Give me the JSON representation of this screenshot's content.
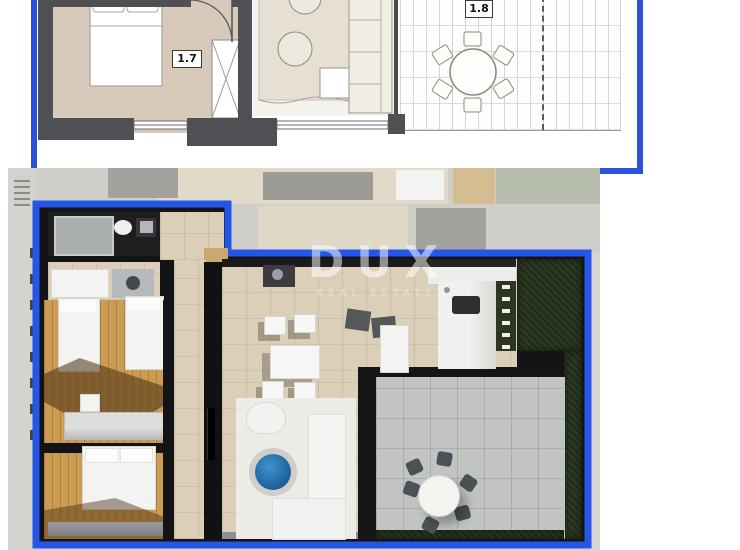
{
  "plan2d": {
    "labels": {
      "bedroom": "1.7",
      "terrace": "1.8"
    },
    "frame_color": "#2d52d9"
  },
  "render3d": {
    "watermark": {
      "title": "DUX",
      "subtitle": "REAL ESTATE"
    },
    "outline_color": "#2456e8"
  },
  "palette": {
    "wall_dark_2d": "#4f5054",
    "bedroom_floor_2d": "#d8cabb",
    "living_rug_2d": "#e6e0d4",
    "wood_floor_3d": "#cc9c55",
    "tile_floor_3d": "#dccfb8",
    "terrace_paving_3d": "#c1c4c1",
    "hedge_green_3d": "#2b3a21",
    "coffee_table_blue_3d": "#1f6fb5",
    "faded_background": "#d6d5d1"
  },
  "icons": [
    "bed-icon",
    "wardrobe-icon",
    "door-arc-icon",
    "dining-table-icon",
    "sofa-icon",
    "toilet-icon",
    "shower-icon",
    "washer-icon",
    "coffee-table-icon"
  ]
}
